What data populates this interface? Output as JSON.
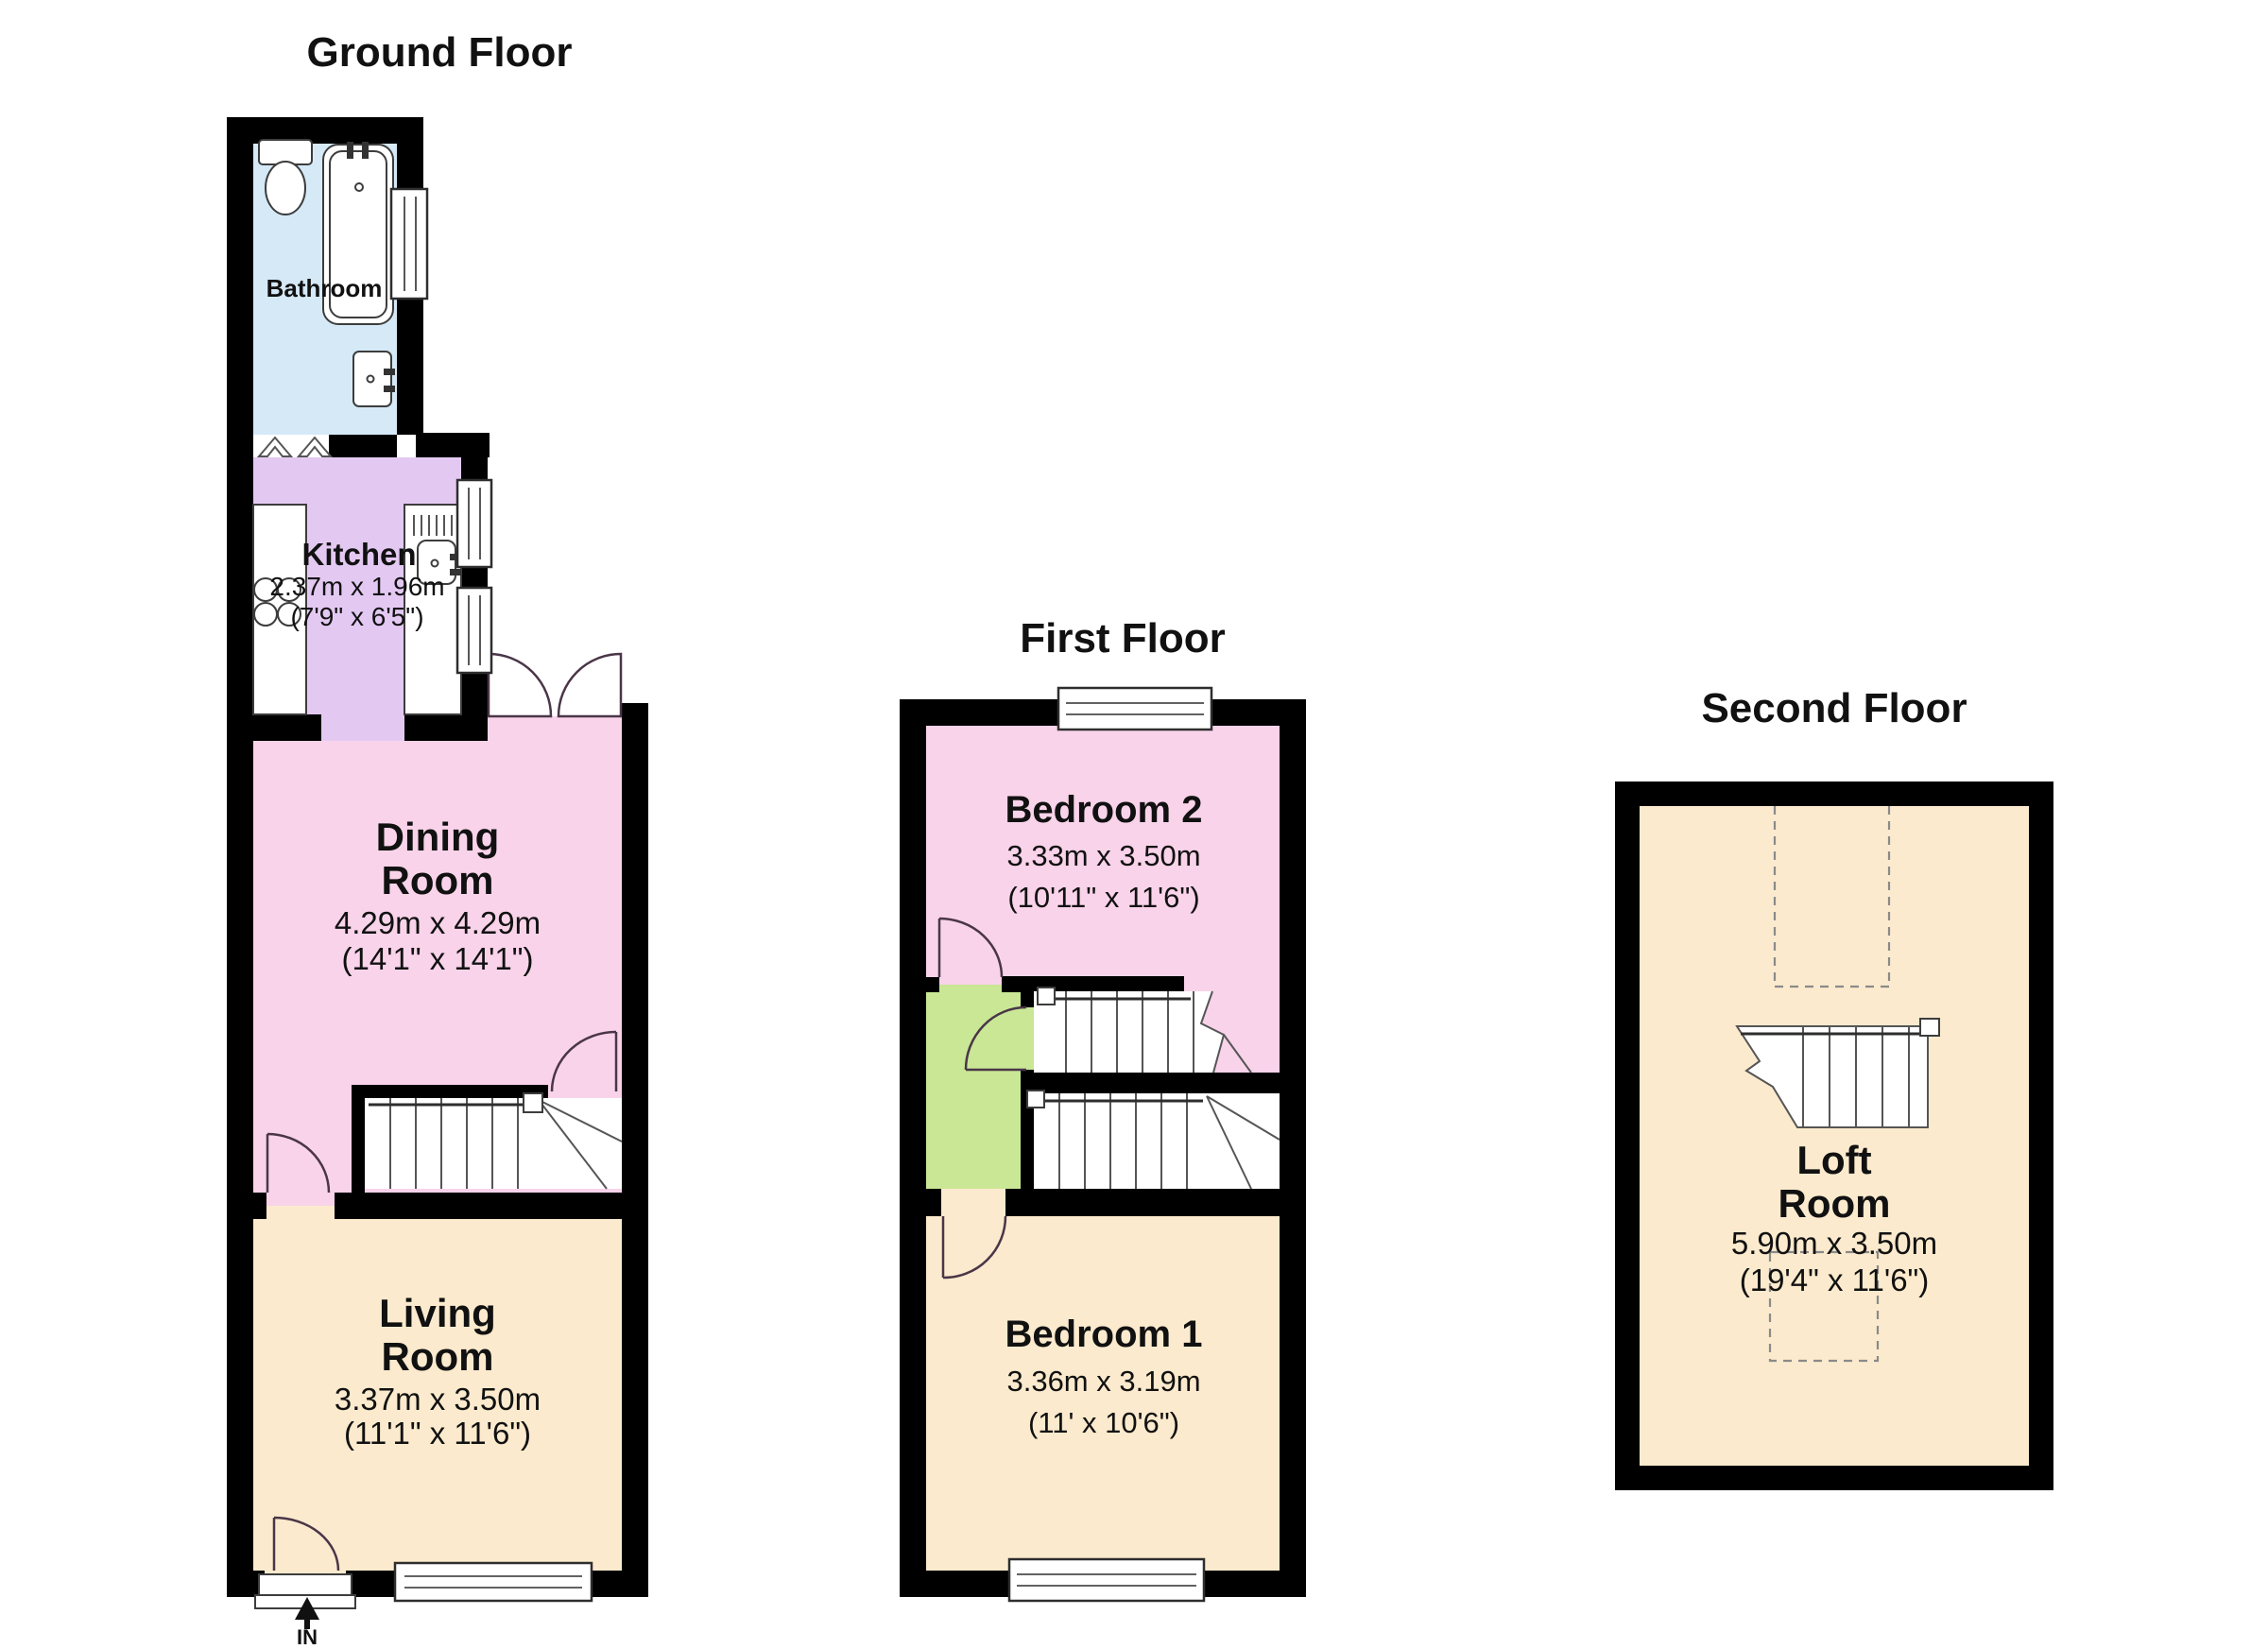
{
  "colors": {
    "wall": "#000000",
    "bathroom_floor": "#d5e9f7",
    "kitchen_floor": "#e3c9f2",
    "dining_floor": "#f9d3ea",
    "living_floor": "#fbeacd",
    "landing_floor": "#c9e795",
    "loft_floor": "#fbeacd"
  },
  "ground": {
    "title": "Ground Floor",
    "bathroom": {
      "label": "Bathroom"
    },
    "kitchen": {
      "name": "Kitchen",
      "metric": "2.37m x 1.96m",
      "imperial": "(7'9\" x 6'5\")"
    },
    "dining": {
      "line1": "Dining",
      "line2": "Room",
      "metric": "4.29m x 4.29m",
      "imperial": "(14'1\" x 14'1\")"
    },
    "living": {
      "line1": "Living",
      "line2": "Room",
      "metric": "3.37m x 3.50m",
      "imperial": "(11'1\" x 11'6\")"
    },
    "entrance_label": "IN"
  },
  "first": {
    "title": "First Floor",
    "bedroom2": {
      "name": "Bedroom 2",
      "metric": "3.33m x 3.50m",
      "imperial": "(10'11\" x 11'6\")"
    },
    "bedroom1": {
      "name": "Bedroom 1",
      "metric": "3.36m x 3.19m",
      "imperial": "(11' x 10'6\")"
    }
  },
  "second": {
    "title": "Second Floor",
    "loft": {
      "line1": "Loft",
      "line2": "Room",
      "metric": "5.90m x 3.50m",
      "imperial": "(19'4\" x 11'6\")"
    }
  }
}
